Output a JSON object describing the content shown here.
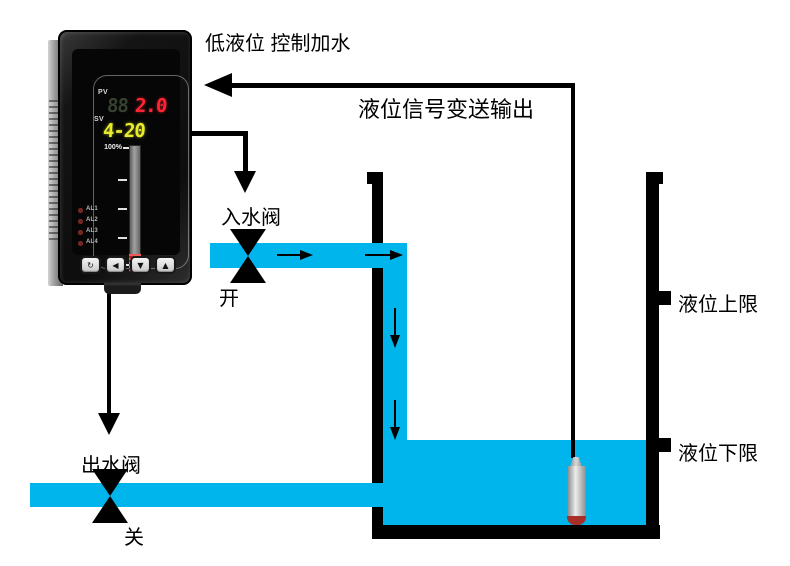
{
  "title": "低液位 控制加水",
  "signal_arrow_label": "液位信号变送输出",
  "inlet_valve": {
    "label": "入水阀",
    "state": "开"
  },
  "outlet_valve": {
    "label": "出水阀",
    "state": "关"
  },
  "tank": {
    "upper_limit_label": "液位上限",
    "lower_limit_label": "液位下限"
  },
  "instrument": {
    "pv_label": "PV",
    "pv_ghost_digits": "88",
    "pv_value": "2.0",
    "sv_label": "SV",
    "sv_value": "4-20",
    "bargraph": {
      "top_label": "100%",
      "bottom_label": "0%"
    },
    "alarm_leds": [
      "AL1",
      "AL2",
      "AL3",
      "AL4"
    ],
    "buttons": [
      "↻",
      "◀",
      "▼",
      "▲"
    ]
  },
  "colors": {
    "water": "#00b4ec",
    "line_black": "#000000",
    "pv_red": "#ff2433",
    "sv_yellow": "#e8ea2e"
  }
}
